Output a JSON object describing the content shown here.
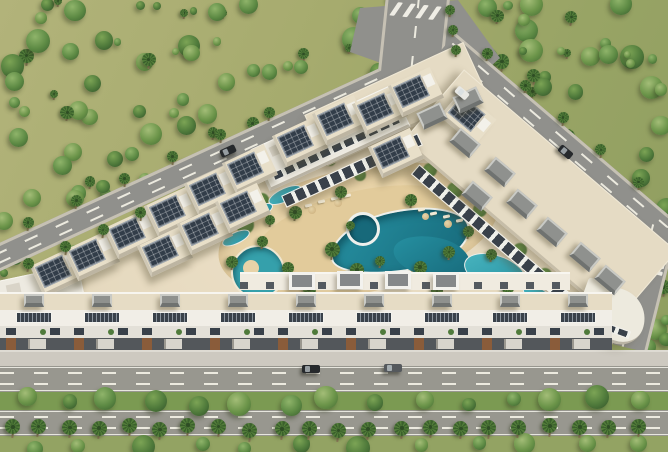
{
  "scene": {
    "title": "aerial-3d-render-residential-compound-with-pool",
    "palette": {
      "ground": "#a6ab6e",
      "tree_palettes": [
        [
          "#8fb46a",
          "#5d8a44",
          "#3a5e2e"
        ],
        [
          "#7ca455",
          "#4f7a3b",
          "#33522a"
        ],
        [
          "#a3bd77",
          "#6b9449",
          "#446b34"
        ]
      ],
      "palm_frond": "#527c39",
      "palm_frond_dark": "#3a602c",
      "palm_trunk": "#8a7a58",
      "road": "#90908c",
      "road_bottom": "#98978f",
      "road_marking": "#eceadf",
      "sidewalk": "#cdc9c0",
      "plaza_sand": "#e3d7bc",
      "deck_sand": "#e8d3a8",
      "deck_inner": "#dfc795",
      "roof_beige": "#e5dbc4",
      "solar_panel": "#323d49",
      "wall_white": "#edeae1",
      "window_dark": "#39414a",
      "bulkhead_grey": "#8f918e",
      "median_green": "#7b9a52",
      "bottom_green": "#93a363",
      "pool_teal": "#2691a2",
      "pool_deep": "#17697a",
      "spa_rim": "#eef0ec",
      "car_dark": "#26292c",
      "car_grey": "#55595d",
      "car_white": "#e8e8e4",
      "brown_accent": "#8a5c3a"
    },
    "counts": {
      "forest_topleft_trees": 150,
      "forest_topright_trees": 70,
      "forest_corner_trees": 12,
      "median_trees": 15,
      "bottom_edge_trees": 12,
      "street_palm_row": 22,
      "diag_road_palms_upper": 7,
      "diag_road_palms_lower": 5,
      "right_road_palms": 6,
      "top_road_palms": 3,
      "zebra_bars": 5,
      "south_townhouse_units": 9
    },
    "solar_villas": [
      {
        "x": 58,
        "y": 272,
        "r": -25
      },
      {
        "x": 92,
        "y": 256,
        "r": -25
      },
      {
        "x": 132,
        "y": 234,
        "r": -25
      },
      {
        "x": 172,
        "y": 212,
        "r": -25
      },
      {
        "x": 212,
        "y": 190,
        "r": -25
      },
      {
        "x": 250,
        "y": 169,
        "r": -25
      },
      {
        "x": 165,
        "y": 252,
        "r": -25
      },
      {
        "x": 205,
        "y": 230,
        "r": -25
      },
      {
        "x": 243,
        "y": 208,
        "r": -25
      },
      {
        "x": 300,
        "y": 142,
        "r": -25
      },
      {
        "x": 340,
        "y": 120,
        "r": -25
      },
      {
        "x": 380,
        "y": 110,
        "r": -25
      },
      {
        "x": 416,
        "y": 92,
        "r": -25
      },
      {
        "x": 396,
        "y": 153,
        "r": -25
      },
      {
        "x": 468,
        "y": 118,
        "r": 40
      }
    ],
    "roof_boxes": [
      {
        "x": 465,
        "y": 143,
        "r": 40
      },
      {
        "x": 500,
        "y": 172,
        "r": 40
      },
      {
        "x": 477,
        "y": 196,
        "r": 40
      },
      {
        "x": 522,
        "y": 204,
        "r": 40
      },
      {
        "x": 552,
        "y": 232,
        "r": 40
      },
      {
        "x": 585,
        "y": 257,
        "r": 40
      },
      {
        "x": 610,
        "y": 280,
        "r": 40
      },
      {
        "x": 468,
        "y": 100,
        "r": -25
      },
      {
        "x": 432,
        "y": 116,
        "r": -25
      }
    ],
    "framed_boxes": [
      {
        "x": 302,
        "y": 281
      },
      {
        "x": 350,
        "y": 280
      },
      {
        "x": 398,
        "y": 280
      },
      {
        "x": 446,
        "y": 281
      }
    ],
    "slabs": [
      {
        "x": 395,
        "y": 104,
        "w": 175,
        "h": 56,
        "r": -24.7,
        "t": "roof"
      },
      {
        "x": 540,
        "y": 196,
        "w": 280,
        "h": 94,
        "r": 40.5,
        "t": "roof"
      },
      {
        "x": 330,
        "y": 138,
        "w": 155,
        "h": 46,
        "r": -24.7,
        "t": "white"
      },
      {
        "x": 352,
        "y": 170,
        "w": 150,
        "h": 13,
        "r": -24.7,
        "t": "winstrip"
      },
      {
        "x": 495,
        "y": 237,
        "w": 210,
        "h": 13,
        "r": 40.5,
        "t": "winstrip"
      },
      {
        "x": 38,
        "y": 298,
        "w": 92,
        "h": 50,
        "r": -12,
        "t": "white"
      },
      {
        "x": 612,
        "y": 314,
        "w": 68,
        "h": 54,
        "r": 20,
        "t": "corner"
      },
      {
        "x": 240,
        "y": 272,
        "w": 0,
        "h": 0,
        "r": 0,
        "t": "terrace"
      }
    ],
    "pools": {
      "deck": {
        "x": 358,
        "y": 230,
        "w": 285,
        "h": 125,
        "r": -12
      },
      "deck_inner": {
        "x": 365,
        "y": 236,
        "w": 225,
        "h": 92,
        "r": -12
      },
      "main": {
        "x": 400,
        "y": 241,
        "w": 142,
        "h": 62,
        "r": -10
      },
      "main2": {
        "x": 432,
        "y": 257,
        "w": 78,
        "h": 40,
        "r": 12
      },
      "spa": {
        "x": 363,
        "y": 229,
        "d": 34
      },
      "lagoon": {
        "x": 258,
        "y": 272,
        "d": 54
      },
      "island": {
        "x": 251,
        "y": 268,
        "d": 16
      },
      "small": [
        {
          "x": 285,
          "y": 195,
          "w": 36,
          "h": 14,
          "r": -25
        },
        {
          "x": 260,
          "y": 211,
          "w": 28,
          "h": 12,
          "r": -25
        },
        {
          "x": 236,
          "y": 238,
          "w": 30,
          "h": 12,
          "r": -25
        },
        {
          "x": 495,
          "y": 272,
          "w": 64,
          "h": 34,
          "r": 18
        },
        {
          "x": 540,
          "y": 298,
          "w": 40,
          "h": 18,
          "r": 35
        },
        {
          "x": 468,
          "y": 299,
          "w": 30,
          "h": 14,
          "r": 0
        }
      ]
    },
    "courtyard_palms": [
      [
        295,
        212,
        13
      ],
      [
        332,
        249,
        15
      ],
      [
        288,
        268,
        12
      ],
      [
        357,
        270,
        14
      ],
      [
        420,
        267,
        13
      ],
      [
        449,
        252,
        12
      ],
      [
        468,
        231,
        11
      ],
      [
        341,
        192,
        12
      ],
      [
        262,
        241,
        11
      ],
      [
        232,
        262,
        12
      ],
      [
        309,
        289,
        13
      ],
      [
        437,
        291,
        12
      ],
      [
        491,
        254,
        11
      ],
      [
        508,
        288,
        12
      ],
      [
        411,
        200,
        12
      ],
      [
        380,
        261,
        10
      ],
      [
        350,
        225,
        9
      ],
      [
        270,
        220,
        10
      ]
    ],
    "green_blobs": [
      [
        245,
        225,
        18
      ],
      [
        262,
        200,
        14
      ],
      [
        300,
        165,
        14
      ],
      [
        330,
        160,
        12
      ],
      [
        430,
        170,
        14
      ],
      [
        455,
        190,
        16
      ],
      [
        480,
        210,
        14
      ],
      [
        250,
        285,
        16
      ],
      [
        290,
        300,
        14
      ],
      [
        520,
        250,
        14
      ],
      [
        545,
        275,
        14
      ],
      [
        360,
        175,
        12
      ]
    ],
    "loungers": [
      [
        305,
        204
      ],
      [
        318,
        200
      ],
      [
        331,
        197
      ],
      [
        344,
        194
      ],
      [
        430,
        212
      ],
      [
        443,
        215
      ],
      [
        456,
        219
      ],
      [
        418,
        208
      ]
    ],
    "umbrellas": [
      [
        312,
        210,
        8
      ],
      [
        338,
        203,
        8
      ],
      [
        448,
        224,
        8
      ],
      [
        425,
        216,
        7
      ]
    ],
    "cars": [
      {
        "x": 228,
        "y": 151,
        "r": -25,
        "c": "car_dark",
        "w": 16
      },
      {
        "x": 462,
        "y": 93,
        "r": 40,
        "c": "car_white",
        "w": 14
      },
      {
        "x": 565,
        "y": 152,
        "r": 40,
        "c": "car_dark",
        "w": 15
      },
      {
        "x": 311,
        "y": 369,
        "r": 0,
        "c": "car_dark",
        "w": 18
      },
      {
        "x": 393,
        "y": 368,
        "r": 0,
        "c": "car_grey",
        "w": 18
      }
    ]
  }
}
